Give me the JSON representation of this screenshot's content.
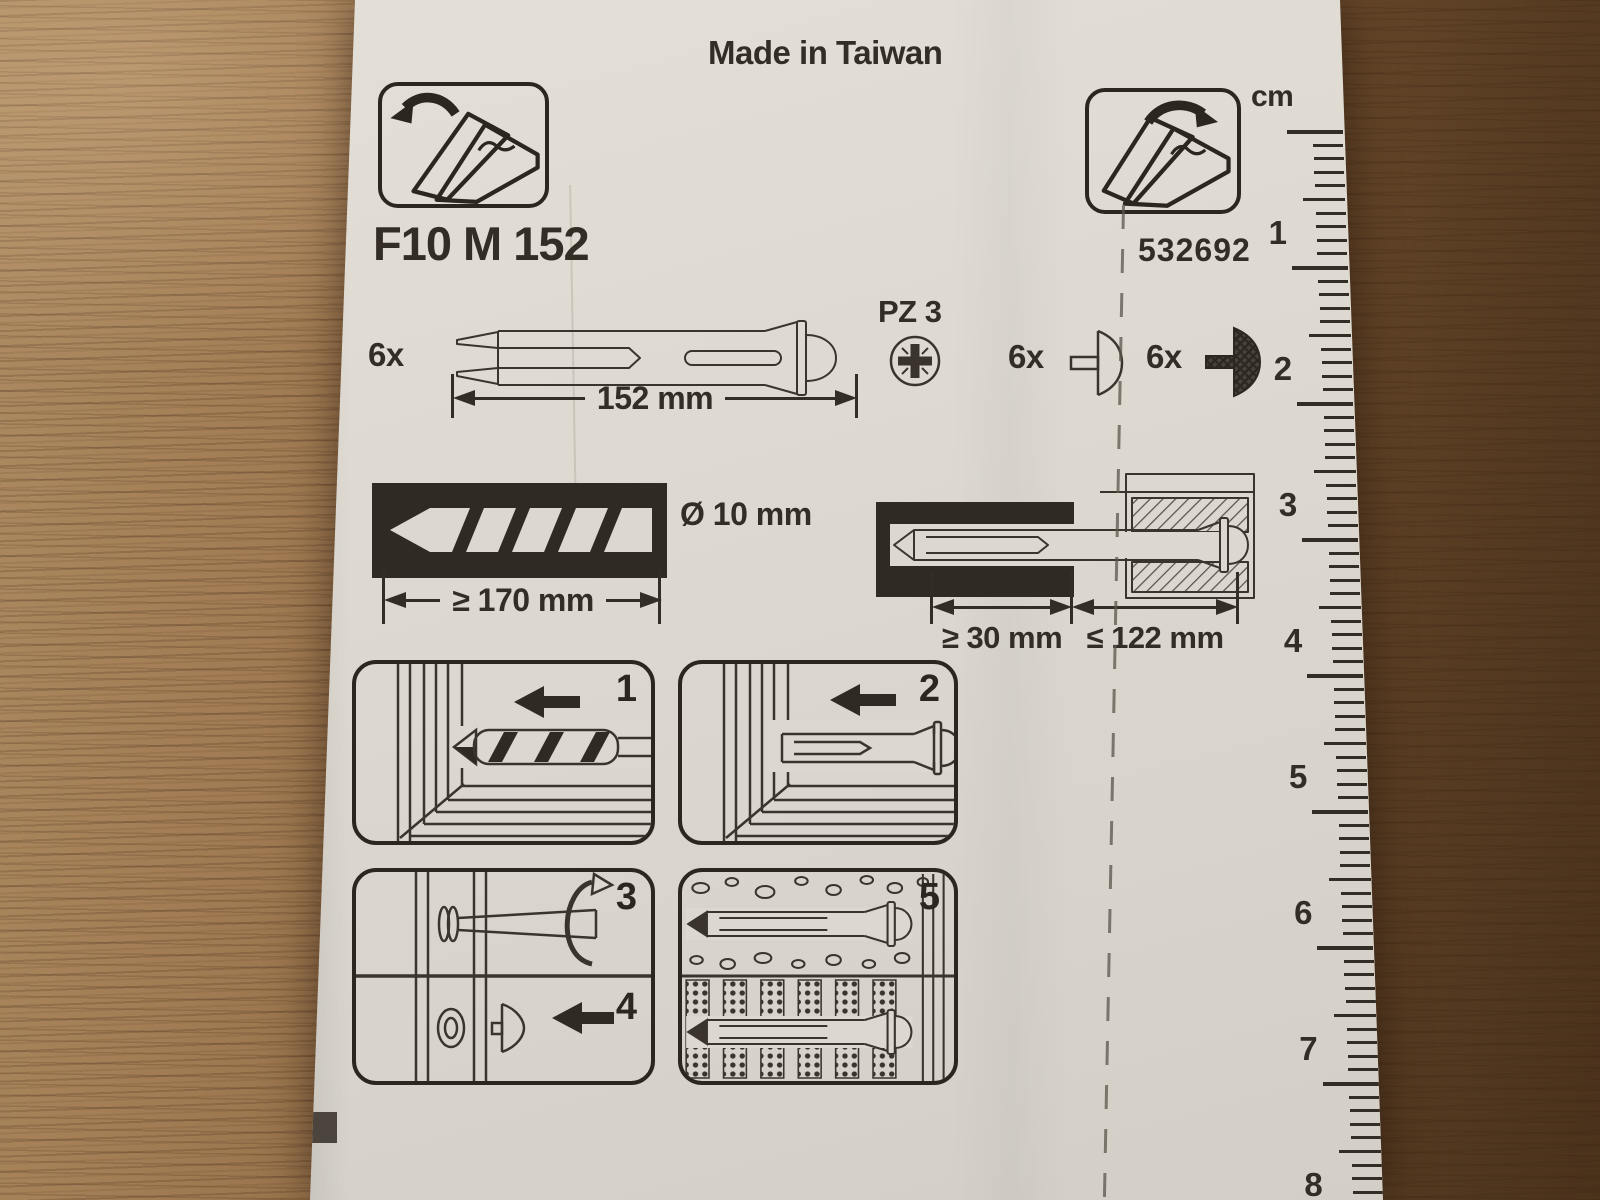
{
  "sheet": {
    "made_in": "Made in Taiwan",
    "product_code": "F10 M 152",
    "article_number": "532692",
    "package": {
      "anchor_qty": "6x",
      "anchor_length": "152 mm",
      "screw_drive": "PZ 3",
      "cap_light_qty": "6x",
      "cap_dark_qty": "6x"
    },
    "drilling": {
      "diameter": "Ø 10 mm",
      "min_hole_depth": "≥ 170 mm"
    },
    "mounting": {
      "min_anchorage": "≥ 30 mm",
      "max_fixture_thickness": "≤ 122 mm"
    },
    "steps": [
      "1",
      "2",
      "3",
      "4",
      "5"
    ],
    "ruler": {
      "unit_label": "cm",
      "numbers": [
        "1",
        "2",
        "3",
        "4",
        "5",
        "6",
        "7",
        "8"
      ]
    },
    "icons": {
      "fold_out_leaflet_left": "flap-open-arrow-left",
      "fold_out_leaflet_right": "flap-open-arrow-right",
      "frame_fixing": "long-sleeve-anchor-with-screw",
      "pozidriv": "PZ3-cross-recess",
      "cover_cap_light": "push-cap-outline",
      "cover_cap_dark": "push-cap-hatched",
      "drill_bit": "drill-in-black-block"
    },
    "colors": {
      "ink": "#332d26",
      "paper": "#dcd8d0",
      "wood_light": "#ad8b62",
      "wood_dark": "#49311b"
    }
  }
}
